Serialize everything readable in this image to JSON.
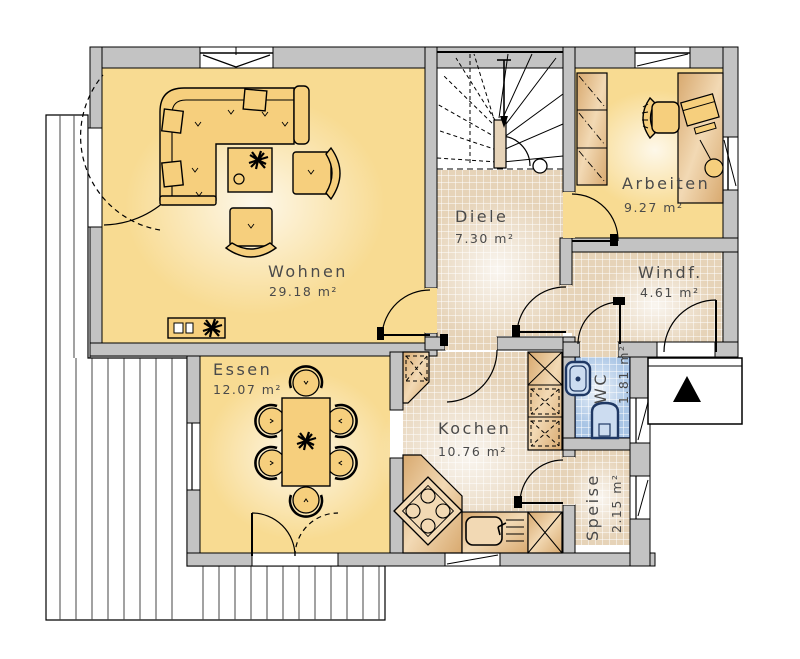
{
  "rooms": {
    "wohnen": {
      "name": "Wohnen",
      "area": "29.18 m²"
    },
    "essen": {
      "name": "Essen",
      "area": "12.07 m²"
    },
    "diele": {
      "name": "Diele",
      "area": "7.30 m²"
    },
    "arbeiten": {
      "name": "Arbeiten",
      "area": "9.27 m²"
    },
    "windfang": {
      "name": "Windf.",
      "area": "4.61 m²"
    },
    "kochen": {
      "name": "Kochen",
      "area": "10.76 m²"
    },
    "wc": {
      "name": "WC",
      "area": "1.81 m²"
    },
    "speise": {
      "name": "Speise",
      "area": "2.15 m²"
    }
  },
  "colors": {
    "wall_gray": "#c3c3c3",
    "room_yellow": "#f8db92",
    "tile_beige": "#e6d3b8",
    "tile_blue": "#a9c5e5",
    "furniture_yellow": "#f6cf7d",
    "fixture_blue_outline": "#1f3864",
    "label_gray": "#4a4a4a"
  }
}
